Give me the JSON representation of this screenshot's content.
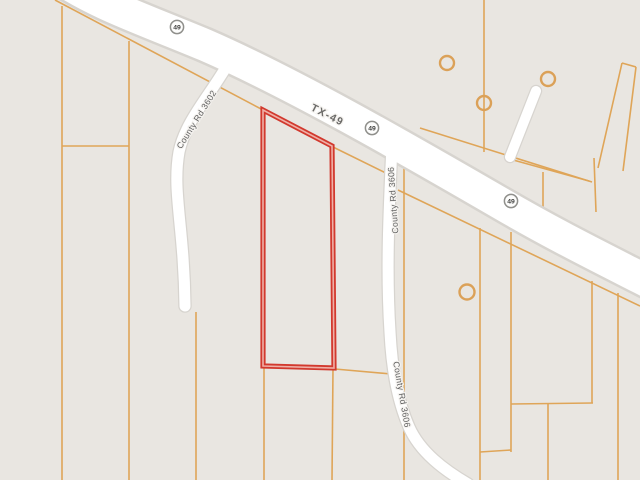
{
  "map": {
    "background_color": "#e9e6e1",
    "parcel_line_color": "#dfa558",
    "road_fill_color": "#ffffff",
    "road_casing_color": "#d7d4cf",
    "subject_parcel_color": "#d2392e",
    "label_color": "#5f5f5f",
    "labels": {
      "highway": "TX-49",
      "shield": "49",
      "county_road_3602": "County Rd 3602",
      "county_road_3606": "County Rd 3606"
    }
  }
}
